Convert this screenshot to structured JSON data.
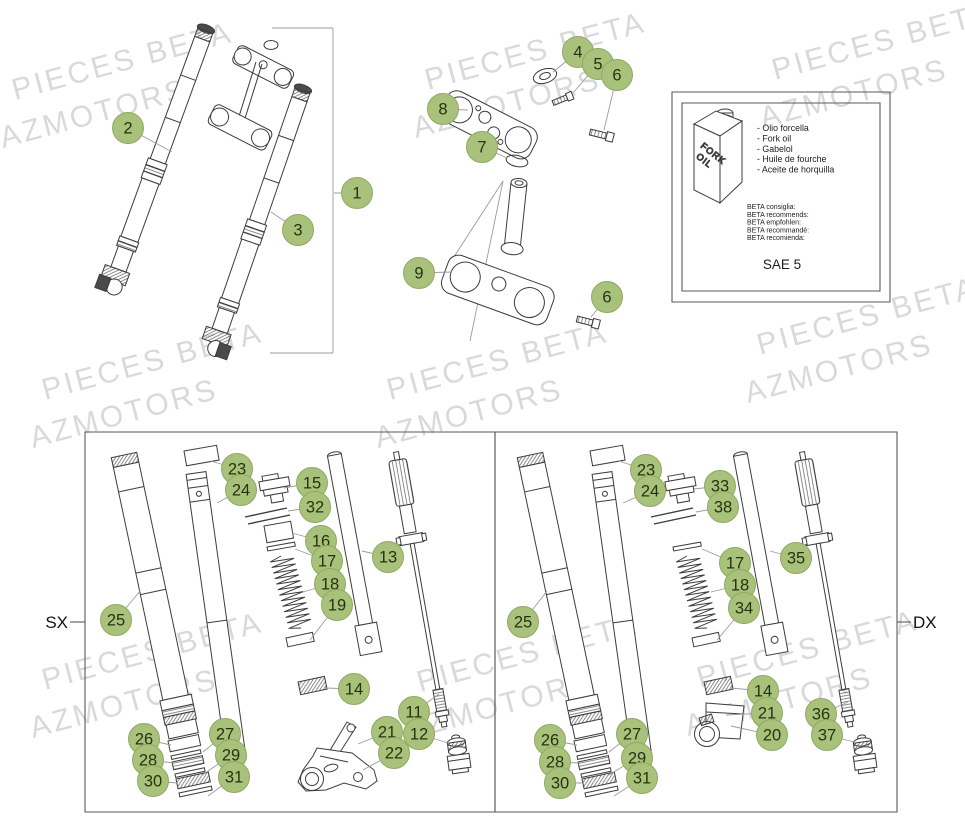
{
  "page": {
    "background": "#ffffff"
  },
  "watermark": {
    "line1": "PIECES BETA",
    "line2": "AZMOTORS",
    "color": "#d9d9d9"
  },
  "colors": {
    "callout_fill": "#a8c27b",
    "callout_border": "#8fa963",
    "callout_text": "#27330f",
    "line_art": "#3c3c3c",
    "leader_line": "#9b9b9b"
  },
  "oil_box": {
    "can_label": "FORK OIL",
    "oil_names": [
      "- Olio forcella",
      "- Fork oil",
      "- Gabelol",
      "- Huile de fourche",
      "- Aceite de horquilla"
    ],
    "recommendations": [
      "BETA consiglia:",
      "BETA recommends:",
      "BETA empfohlen:",
      "BETA recommandé:",
      "BETA recomienda:"
    ],
    "grade": "SAE 5"
  },
  "assembly": {
    "callouts": [
      {
        "n": "1",
        "cx": 357,
        "cy": 193,
        "lx": 334,
        "ly": 193
      },
      {
        "n": "2",
        "cx": 128,
        "cy": 128,
        "lx": 172,
        "ly": 152
      },
      {
        "n": "3",
        "cx": 298,
        "cy": 230,
        "lx": 271,
        "ly": 212
      }
    ]
  },
  "steering": {
    "callouts": [
      {
        "n": "8",
        "cx": 443,
        "cy": 109,
        "lx": 468,
        "ly": 110
      },
      {
        "n": "4",
        "cx": 578,
        "cy": 52,
        "lx": 553,
        "ly": 72
      },
      {
        "n": "5",
        "cx": 598,
        "cy": 64,
        "lx": 572,
        "ly": 94
      },
      {
        "n": "6",
        "cx": 617,
        "cy": 75,
        "lx": 604,
        "ly": 130
      },
      {
        "n": "7",
        "cx": 482,
        "cy": 147,
        "lx": 507,
        "ly": 158
      },
      {
        "n": "9",
        "cx": 419,
        "cy": 273,
        "lx": 452,
        "ly": 272
      },
      {
        "n": "6",
        "cx": 607,
        "cy": 297,
        "lx": 591,
        "ly": 317
      }
    ]
  },
  "panels": {
    "left": {
      "label": "SX",
      "callouts": [
        {
          "n": "23",
          "cx": 237,
          "cy": 469,
          "lx": 211,
          "ly": 461
        },
        {
          "n": "24",
          "cx": 241,
          "cy": 490,
          "lx": 217,
          "ly": 503
        },
        {
          "n": "15",
          "cx": 312,
          "cy": 483,
          "lx": 284,
          "ly": 488
        },
        {
          "n": "32",
          "cx": 315,
          "cy": 507,
          "lx": 288,
          "ly": 511
        },
        {
          "n": "16",
          "cx": 321,
          "cy": 541,
          "lx": 292,
          "ly": 533
        },
        {
          "n": "17",
          "cx": 327,
          "cy": 561,
          "lx": 295,
          "ly": 549
        },
        {
          "n": "18",
          "cx": 330,
          "cy": 584,
          "lx": 303,
          "ly": 592
        },
        {
          "n": "19",
          "cx": 337,
          "cy": 605,
          "lx": 310,
          "ly": 640
        },
        {
          "n": "13",
          "cx": 388,
          "cy": 557,
          "lx": 362,
          "ly": 551
        },
        {
          "n": "25",
          "cx": 116,
          "cy": 620,
          "lx": 140,
          "ly": 591
        },
        {
          "n": "14",
          "cx": 354,
          "cy": 689,
          "lx": 325,
          "ly": 688
        },
        {
          "n": "11",
          "cx": 414,
          "cy": 712,
          "lx": 439,
          "ly": 694
        },
        {
          "n": "12",
          "cx": 419,
          "cy": 734,
          "lx": 448,
          "ly": 743
        },
        {
          "n": "21",
          "cx": 387,
          "cy": 732,
          "lx": 358,
          "ly": 744
        },
        {
          "n": "22",
          "cx": 394,
          "cy": 753,
          "lx": 363,
          "ly": 770
        },
        {
          "n": "26",
          "cx": 144,
          "cy": 739,
          "lx": 171,
          "ly": 745
        },
        {
          "n": "27",
          "cx": 225,
          "cy": 734,
          "lx": 203,
          "ly": 752
        },
        {
          "n": "28",
          "cx": 148,
          "cy": 760,
          "lx": 174,
          "ly": 763
        },
        {
          "n": "29",
          "cx": 231,
          "cy": 755,
          "lx": 201,
          "ly": 776
        },
        {
          "n": "30",
          "cx": 153,
          "cy": 781,
          "lx": 178,
          "ly": 783
        },
        {
          "n": "31",
          "cx": 234,
          "cy": 777,
          "lx": 208,
          "ly": 796
        }
      ]
    },
    "right": {
      "label": "DX",
      "callouts": [
        {
          "n": "23",
          "cx": 646,
          "cy": 470,
          "lx": 619,
          "ly": 461
        },
        {
          "n": "24",
          "cx": 650,
          "cy": 491,
          "lx": 623,
          "ly": 503
        },
        {
          "n": "33",
          "cx": 720,
          "cy": 486,
          "lx": 694,
          "ly": 489
        },
        {
          "n": "38",
          "cx": 723,
          "cy": 507,
          "lx": 696,
          "ly": 512
        },
        {
          "n": "17",
          "cx": 735,
          "cy": 563,
          "lx": 702,
          "ly": 549
        },
        {
          "n": "18",
          "cx": 740,
          "cy": 585,
          "lx": 711,
          "ly": 592
        },
        {
          "n": "34",
          "cx": 744,
          "cy": 608,
          "lx": 717,
          "ly": 640
        },
        {
          "n": "35",
          "cx": 796,
          "cy": 558,
          "lx": 770,
          "ly": 551
        },
        {
          "n": "25",
          "cx": 523,
          "cy": 622,
          "lx": 547,
          "ly": 591
        },
        {
          "n": "14",
          "cx": 763,
          "cy": 691,
          "lx": 731,
          "ly": 688
        },
        {
          "n": "21",
          "cx": 767,
          "cy": 713,
          "lx": 726,
          "ly": 715
        },
        {
          "n": "20",
          "cx": 772,
          "cy": 735,
          "lx": 731,
          "ly": 726
        },
        {
          "n": "36",
          "cx": 821,
          "cy": 714,
          "lx": 848,
          "ly": 702
        },
        {
          "n": "37",
          "cx": 827,
          "cy": 735,
          "lx": 854,
          "ly": 742
        },
        {
          "n": "26",
          "cx": 550,
          "cy": 740,
          "lx": 577,
          "ly": 745
        },
        {
          "n": "27",
          "cx": 632,
          "cy": 734,
          "lx": 609,
          "ly": 752
        },
        {
          "n": "28",
          "cx": 555,
          "cy": 762,
          "lx": 580,
          "ly": 763
        },
        {
          "n": "29",
          "cx": 637,
          "cy": 758,
          "lx": 607,
          "ly": 776
        },
        {
          "n": "30",
          "cx": 560,
          "cy": 783,
          "lx": 584,
          "ly": 783
        },
        {
          "n": "31",
          "cx": 642,
          "cy": 778,
          "lx": 614,
          "ly": 796
        }
      ]
    }
  }
}
